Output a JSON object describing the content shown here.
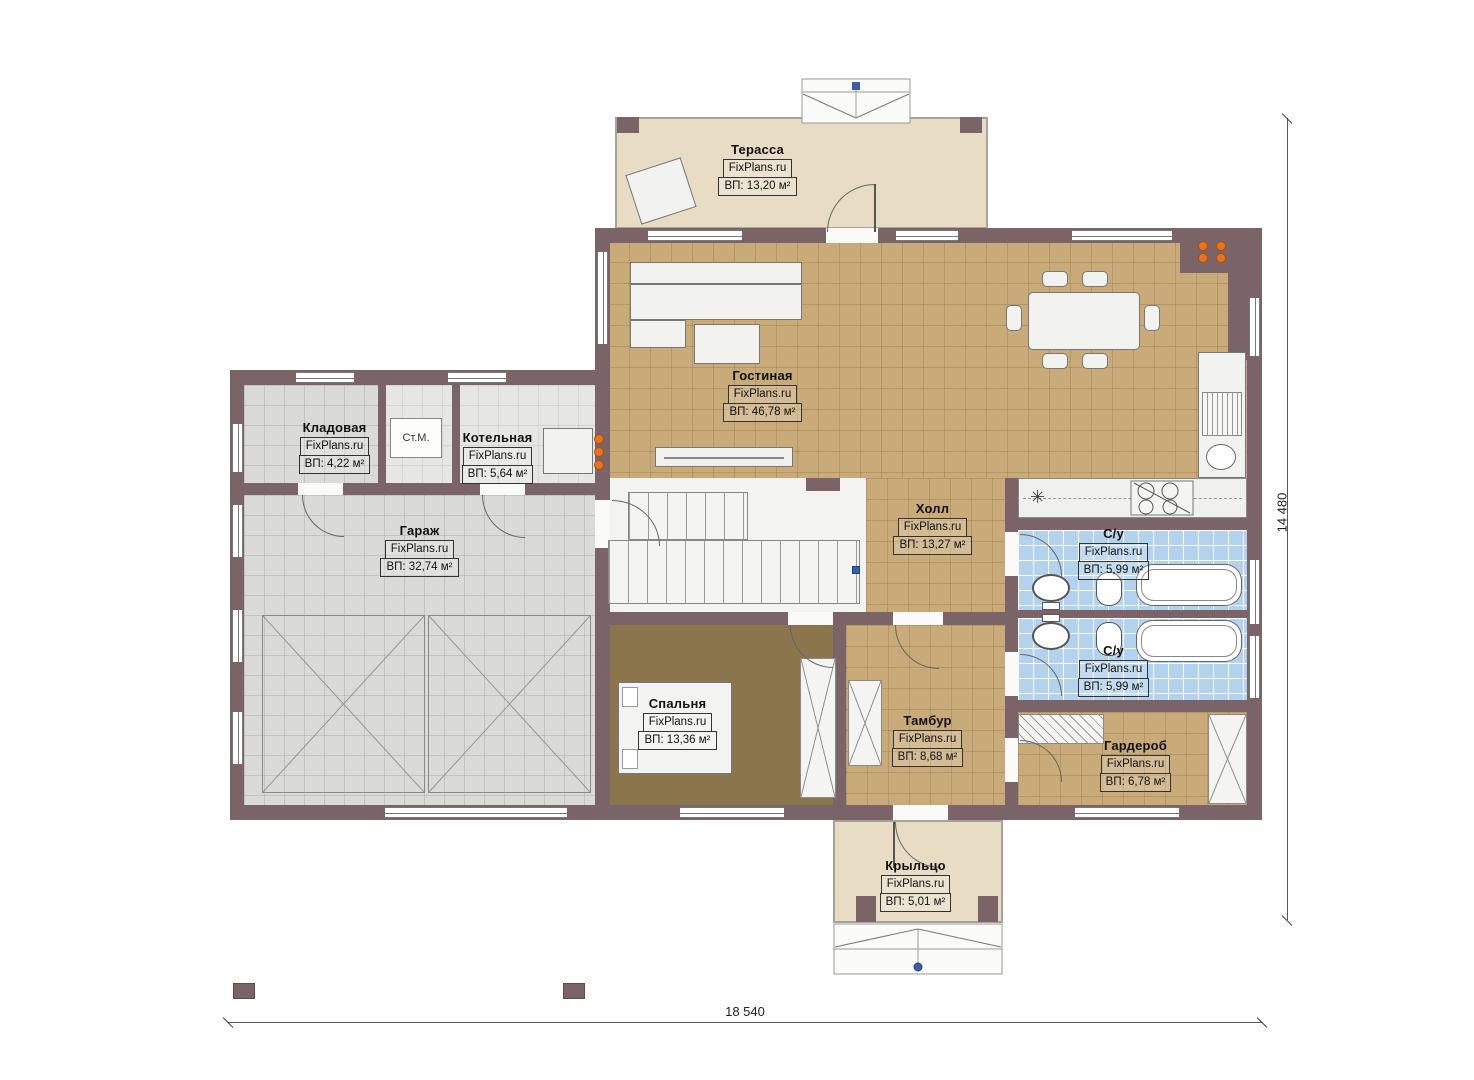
{
  "plan": {
    "rooms": [
      {
        "name": "Терасса",
        "brand": "FixPlans.ru",
        "area": "ВП: 13,20 м²"
      },
      {
        "name": "Гостиная",
        "brand": "FixPlans.ru",
        "area": "ВП: 46,78 м²"
      },
      {
        "name": "Кладовая",
        "brand": "FixPlans.ru",
        "area": "ВП: 4,22 м²"
      },
      {
        "name": "Котельная",
        "brand": "FixPlans.ru",
        "area": "ВП: 5,64 м²"
      },
      {
        "name": "Гараж",
        "brand": "FixPlans.ru",
        "area": "ВП: 32,74 м²"
      },
      {
        "name": "Холл",
        "brand": "FixPlans.ru",
        "area": "ВП: 13,27 м²"
      },
      {
        "name": "С/у",
        "brand": "FixPlans.ru",
        "area": "ВП: 5,99 м²"
      },
      {
        "name": "С/у",
        "brand": "FixPlans.ru",
        "area": "ВП: 5,99 м²"
      },
      {
        "name": "Спальня",
        "brand": "FixPlans.ru",
        "area": "ВП: 13,36 м²"
      },
      {
        "name": "Тамбур",
        "brand": "FixPlans.ru",
        "area": "ВП: 8,68 м²"
      },
      {
        "name": "Гардероб",
        "brand": "FixPlans.ru",
        "area": "ВП: 6,78 м²"
      },
      {
        "name": "Крыльцо",
        "brand": "FixPlans.ru",
        "area": "ВП: 5,01 м²"
      }
    ],
    "annotations": {
      "washing_machine": "Ст.М.",
      "sink_symbol": "✳"
    },
    "dimensions": {
      "overall_width": "18 540",
      "overall_height": "14 480"
    },
    "colors": {
      "wall": "#7b6467",
      "floor_tan": "#c9ab79",
      "floor_brown": "#8b754d",
      "floor_gray": "#dadad8",
      "floor_blue": "#b3d2ed",
      "floor_terrace": "#e8dcc4",
      "accent_orange": "#e8731e",
      "accent_blue": "#3a5ea8"
    }
  }
}
